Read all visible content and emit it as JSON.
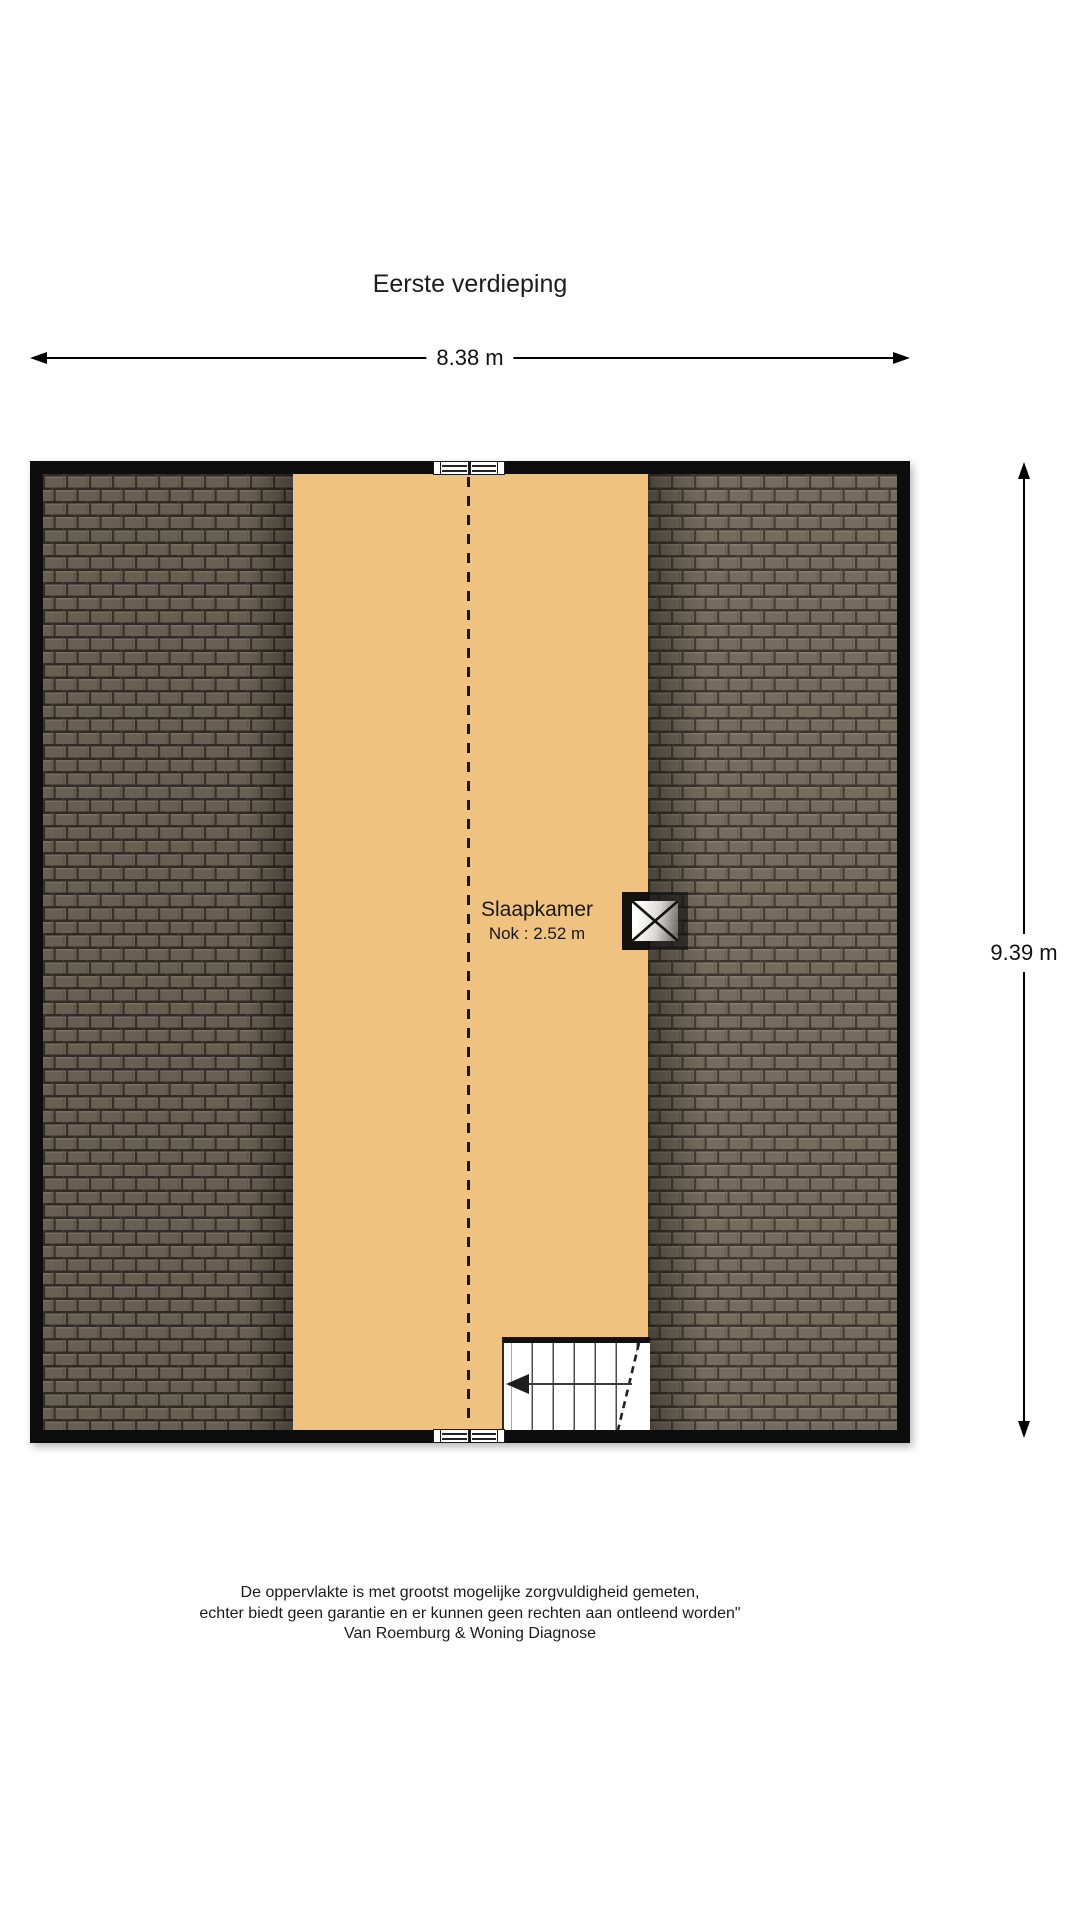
{
  "title": "Eerste verdieping",
  "dimensions": {
    "width_label": "8.38 m",
    "height_label": "9.39 m"
  },
  "room": {
    "name": "Slaapkamer",
    "detail": "Nok : 2.52 m"
  },
  "footer": {
    "lines": [
      "De oppervlakte is met grootst mogelijke zorgvuldigheid gemeten,",
      "echter biedt geen garantie en er kunnen geen rechten aan ontleend worden\"",
      "Van Roemburg & Woning Diagnose"
    ]
  },
  "icons": {
    "dimension_arrow_left": "left-triangle",
    "dimension_arrow_right": "right-triangle",
    "dimension_arrow_up": "up-triangle",
    "dimension_arrow_down": "down-triangle",
    "stairs_direction_arrow": "left-triangle",
    "roof_window_cross": "x-cross"
  },
  "colors": {
    "floor": "#efc37f",
    "wall": "#0d0d0d",
    "roof_tile_left": "#675f52",
    "roof_tile_right": "#746c5e",
    "background": "#ffffff"
  }
}
